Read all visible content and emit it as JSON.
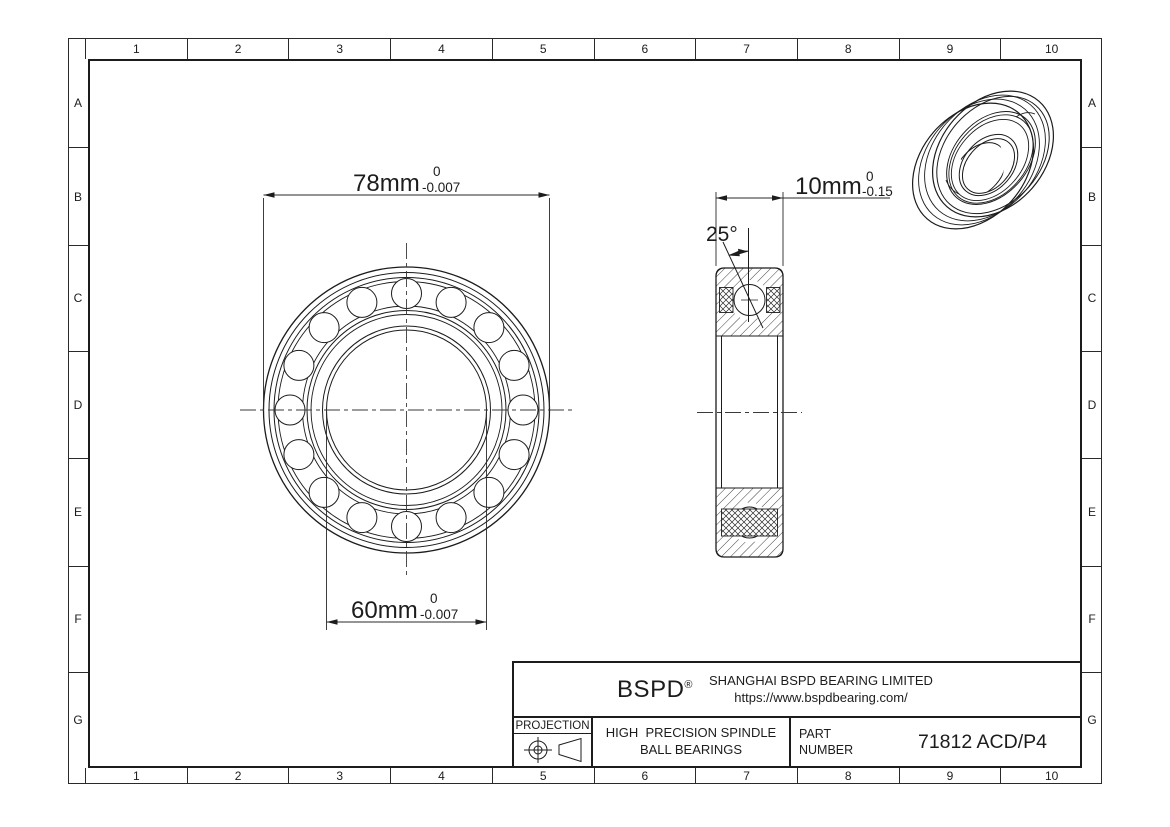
{
  "sheet": {
    "part_number": "71812 ACD/P4",
    "company": {
      "logo": "BSPD",
      "registered_mark": "®",
      "name": "SHANGHAI BSPD BEARING LIMITED",
      "website": "https://www.bspdbearing.com/"
    },
    "title_block": {
      "projection_label": "PROJECTION",
      "product_line1": "HIGH  PRECISION SPINDLE",
      "product_line2": "BALL BEARINGS",
      "part_label_line1": "PART",
      "part_label_line2": "NUMBER"
    },
    "dimensions": {
      "outer_diameter": {
        "value": "78mm",
        "tol_upper": "0",
        "tol_lower": "-0.007"
      },
      "bore_diameter": {
        "value": "60mm",
        "tol_upper": "0",
        "tol_lower": "-0.007"
      },
      "width": {
        "value": "10mm",
        "tol_upper": "0",
        "tol_lower": "-0.15"
      },
      "contact_angle": "25°"
    },
    "border": {
      "columns": [
        "1",
        "2",
        "3",
        "4",
        "5",
        "6",
        "7",
        "8",
        "9",
        "10"
      ],
      "rows": [
        "A",
        "B",
        "C",
        "D",
        "E",
        "F",
        "G"
      ]
    },
    "colors": {
      "line": "#1c1c1c",
      "background": "#ffffff"
    }
  }
}
